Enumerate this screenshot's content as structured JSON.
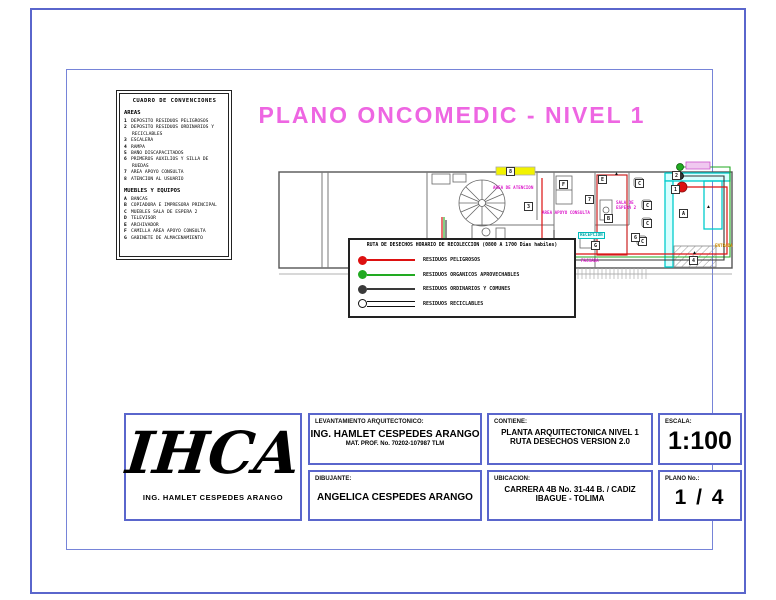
{
  "page": {
    "title": "PLANO ONCOMEDIC  -  NIVEL 1"
  },
  "colors": {
    "border_blue": "#5a66cc",
    "title_magenta": "#ee66e2",
    "route_red": "#dd1111",
    "route_green": "#22aa22",
    "route_black": "#333333",
    "cyan": "#00cccc",
    "yellow": "#f2f200"
  },
  "conventions": {
    "title": "CUADRO DE CONVENCIONES",
    "areas_heading": "AREAS",
    "areas": [
      {
        "n": "1",
        "label": "DEPOSITO RESIDUOS PELIGROSOS"
      },
      {
        "n": "2",
        "label": "DEPOSITO RESIDUOS ORDINARIOS Y RECICLABLES"
      },
      {
        "n": "3",
        "label": "ESCALERA"
      },
      {
        "n": "4",
        "label": "RAMPA"
      },
      {
        "n": "5",
        "label": "BAÑO DISCAPACITADOS"
      },
      {
        "n": "6",
        "label": "PRIMEROS AUXILIOS Y SILLA DE RUEDAS"
      },
      {
        "n": "7",
        "label": "AREA APOYO CONSULTA"
      },
      {
        "n": "8",
        "label": "ATENCION AL USUARIO"
      }
    ],
    "muebles_heading": "MUEBLES Y EQUIPOS",
    "muebles": [
      {
        "n": "A",
        "label": "BANCAS"
      },
      {
        "n": "B",
        "label": "COPIADORA E IMPRESORA PRINCIPAL"
      },
      {
        "n": "C",
        "label": "MUEBLES SALA DE ESPERA 2"
      },
      {
        "n": "D",
        "label": "TELEVISOR"
      },
      {
        "n": "E",
        "label": "ARCHIVADOR"
      },
      {
        "n": "F",
        "label": "CAMILLA AREA APOYO CONSULTA"
      },
      {
        "n": "G",
        "label": "GABINETE DE ALMACENAMIENTO"
      }
    ]
  },
  "plan": {
    "labels": [
      {
        "text": "AREA DE ATENCION",
        "x": 221,
        "y": 26,
        "color": "#dd22cc",
        "boxed": false
      },
      {
        "text": "AREA APOYO CONSULTA",
        "x": 270,
        "y": 51,
        "color": "#dd22cc",
        "boxed": false
      },
      {
        "text": "SALA DE\nESPERA 2",
        "x": 344,
        "y": 41,
        "color": "#dd22cc",
        "boxed": false
      },
      {
        "text": "RECEPCION",
        "x": 306,
        "y": 72,
        "color": "#00a8a8",
        "boxed": true
      },
      {
        "text": "FACHADA",
        "x": 309,
        "y": 99,
        "color": "#dd22cc",
        "boxed": false
      },
      {
        "text": "ENTRADA",
        "x": 443,
        "y": 84,
        "color": "#cc8800",
        "boxed": false
      }
    ],
    "markers": [
      {
        "t": "8",
        "x": 234,
        "y": 7
      },
      {
        "t": "3",
        "x": 252,
        "y": 42
      },
      {
        "t": "F",
        "x": 287,
        "y": 20
      },
      {
        "t": "7",
        "x": 313,
        "y": 35
      },
      {
        "t": "5",
        "x": 237,
        "y": 82
      },
      {
        "t": "B",
        "x": 332,
        "y": 54
      },
      {
        "t": "E",
        "x": 326,
        "y": 15
      },
      {
        "t": "C",
        "x": 363,
        "y": 19
      },
      {
        "t": "C",
        "x": 371,
        "y": 41
      },
      {
        "t": "C",
        "x": 371,
        "y": 59
      },
      {
        "t": "C",
        "x": 366,
        "y": 77
      },
      {
        "t": "2",
        "x": 400,
        "y": 11
      },
      {
        "t": "1",
        "x": 399,
        "y": 25
      },
      {
        "t": "6",
        "x": 359,
        "y": 73
      },
      {
        "t": "4",
        "x": 417,
        "y": 96
      },
      {
        "t": "A",
        "x": 407,
        "y": 49
      },
      {
        "t": "G",
        "x": 319,
        "y": 81
      }
    ],
    "arrows": [
      {
        "x": 342,
        "y": 12
      },
      {
        "x": 434,
        "y": 45
      },
      {
        "x": 420,
        "y": 91
      },
      {
        "x": 290,
        "y": 91
      }
    ]
  },
  "route_legend": {
    "title": "RUTA DE DESECHOS HORARIO DE RECOLECCION (0800 A 1700 Dias habiles)",
    "items": [
      {
        "label": "RESIDUOS PELIGROSOS",
        "color": "#dd1111",
        "line": "solid"
      },
      {
        "label": "RESIDUOS ORGANICOS APROVECHABLES",
        "color": "#22aa22",
        "line": "solid"
      },
      {
        "label": "RESIDUOS ORDINARIOS Y COMUNES",
        "color": "#3a3a3a",
        "line": "solid"
      },
      {
        "label": "RESIDUOS RECICLABLES",
        "color": "#ffffff",
        "line": "double"
      }
    ]
  },
  "titleblock": {
    "logo_text": "IHCA",
    "logo_sub": "ING. HAMLET CESPEDES ARANGO",
    "levantamiento_label": "LEVANTAMIENTO ARQUITECTONICO:",
    "levantamiento_name": "ING. HAMLET CESPEDES ARANGO",
    "levantamiento_mat": "MAT. PROF. No. 70202-107987 TLM",
    "dibujante_label": "DIBUJANTE:",
    "dibujante_name": "ANGELICA CESPEDES ARANGO",
    "contiene_label": "CONTIENE:",
    "contiene_line1": "PLANTA ARQUITECTONICA NIVEL 1",
    "contiene_line2": "RUTA DESECHOS VERSION 2.0",
    "ubicacion_label": "UBICACION:",
    "ubicacion_line1": "CARRERA 4B No. 31-44  B. / CADIZ",
    "ubicacion_line2": "IBAGUE - TOLIMA",
    "escala_label": "ESCALA:",
    "escala_value": "1:100",
    "plano_label": "PLANO No.:",
    "plano_value": "1 / 4"
  }
}
